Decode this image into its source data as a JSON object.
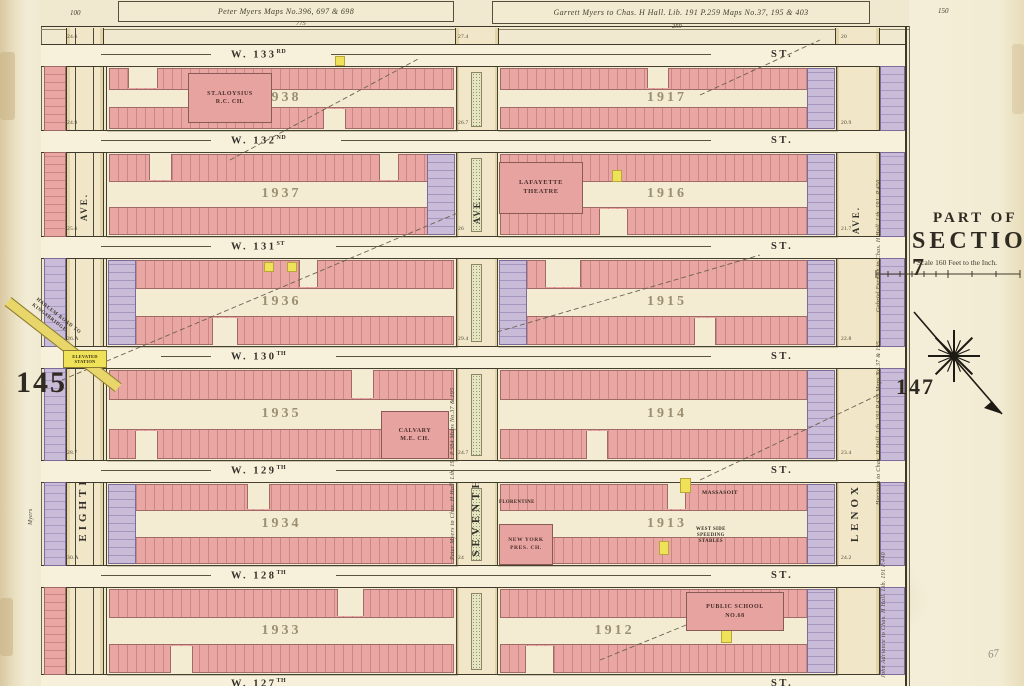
{
  "palette": {
    "pink": "#e9a6a2",
    "lavender": "#c7bad6",
    "yellow": "#efe158",
    "green": "#8fae7e",
    "ink": "#3e3829",
    "parchment": "#f1e9cf"
  },
  "page": {
    "left_number": "145",
    "right_number": "147",
    "pencil_note": "67"
  },
  "top_margin": {
    "left_deed": "Peter Myers  Maps No.396, 697 & 698",
    "left_sub": "775",
    "right_deed": "Garrett Myers to Chas. H Hall.  Lib. 191 P.259  Maps No.37, 195 & 403",
    "right_sub": "259",
    "corner_left": "100",
    "corner_right": "150"
  },
  "section_panel": {
    "part_of": "PART OF",
    "title": "SECTION 7",
    "scale": "Scale 160 Feet to the Inch."
  },
  "avenues": [
    {
      "name": "EIGHTH",
      "ave": "AVE."
    },
    {
      "name": "SEVENTH",
      "ave": "AVE."
    },
    {
      "name": "LENOX",
      "ave": "AVE."
    }
  ],
  "streets": [
    {
      "name": "W. 133",
      "suffix": "RD",
      "st": "ST."
    },
    {
      "name": "W. 132",
      "suffix": "ND",
      "st": "ST."
    },
    {
      "name": "W. 131",
      "suffix": "ST",
      "st": "ST."
    },
    {
      "name": "W. 130",
      "suffix": "TH",
      "st": "ST."
    },
    {
      "name": "W. 129",
      "suffix": "TH",
      "st": "ST."
    },
    {
      "name": "W. 128",
      "suffix": "TH",
      "st": "ST."
    },
    {
      "name": "W. 127",
      "suffix": "TH",
      "st": "ST."
    }
  ],
  "blocks": {
    "west": [
      "1938",
      "1937",
      "1936",
      "1935",
      "1934",
      "1933"
    ],
    "east": [
      "1917",
      "1916",
      "1915",
      "1914",
      "1913",
      "1912"
    ]
  },
  "landmarks": {
    "st_aloysius": {
      "l1": "ST.ALOYSIUS",
      "l2": "R.C. CH."
    },
    "lafayette": {
      "l1": "LAFAYETTE",
      "l2": "THEATRE"
    },
    "calvary": {
      "l1": "CALVARY",
      "l2": "M.E. CH."
    },
    "ny_pres": {
      "l1": "NEW YORK",
      "l2": "PRES. CH."
    },
    "florentine": {
      "l1": "FLORENTINE"
    },
    "massasoit": {
      "l1": "MASSASOIT"
    },
    "west_side": {
      "l1": "WEST SIDE",
      "l2": "SPEEDING",
      "l3": "STABLES"
    },
    "public_school": {
      "l1": "PUBLIC SCHOOL",
      "l2": "NO.68"
    },
    "elevated_station": {
      "l1": "ELEVATED",
      "l2": "STATION"
    },
    "old_road": {
      "l1": "HARLEM ROAD TO",
      "l2": "KINGSBRIDGE"
    }
  },
  "deeds": {
    "seventh_west": "Peter Myers to Chas. H Hall. Lib. 191 P.384 Maps No.37 & 195",
    "lenox_upper": "Gabriel Furman to Chas. H Hall. Lib. 191. P.450",
    "lenox_lower": "Harrison to Chas. H Hall. Lib. 191 P.439 Maps No.37 & 195",
    "lenox_bottom": "John Adriance to Chas. H Hall. Lib. 191 P.440",
    "west_margin": "Myers"
  },
  "edge_numbers": [
    {
      "v": "24.6"
    },
    {
      "v": "24.9"
    },
    {
      "v": "25.6"
    },
    {
      "v": "26.A"
    },
    {
      "v": "28.7"
    },
    {
      "v": "30.A"
    },
    {
      "v": "27.4"
    },
    {
      "v": "26.7"
    },
    {
      "v": "26"
    },
    {
      "v": "29.4"
    },
    {
      "v": "24.7"
    },
    {
      "v": "24"
    },
    {
      "v": "20"
    },
    {
      "v": "20.9"
    },
    {
      "v": "21.7"
    },
    {
      "v": "22.8"
    },
    {
      "v": "23.4"
    },
    {
      "v": "24.2"
    }
  ]
}
